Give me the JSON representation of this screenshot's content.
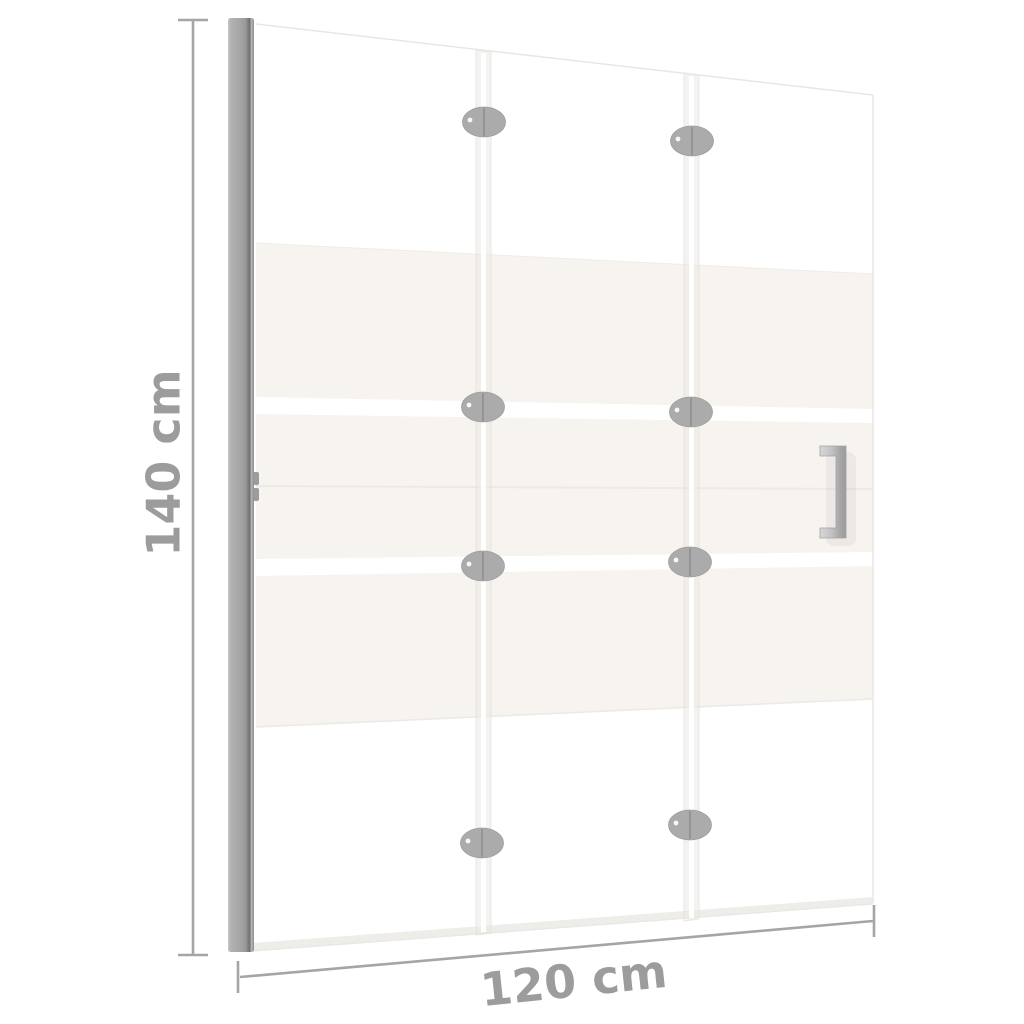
{
  "dimensions": {
    "height": "140 cm",
    "width": "120 cm"
  },
  "structure": {
    "panel_count": 3,
    "hinge_count": 8,
    "frosted_band_count": 3
  },
  "colors": {
    "background": "#ffffff",
    "dimension_line": "#a5a5a5",
    "dimension_text": "#9c9c9c",
    "frame_profile": "#a6a6a6",
    "frame_profile_dark": "#787878",
    "frame_profile_light": "#c6c6c6",
    "frosted_glass": "#f7f4f0",
    "glass_edge": "#e9e6e3",
    "hinge": "#ababab",
    "handle": "#b5b5b5",
    "seam_highlight": "#ffffff"
  }
}
